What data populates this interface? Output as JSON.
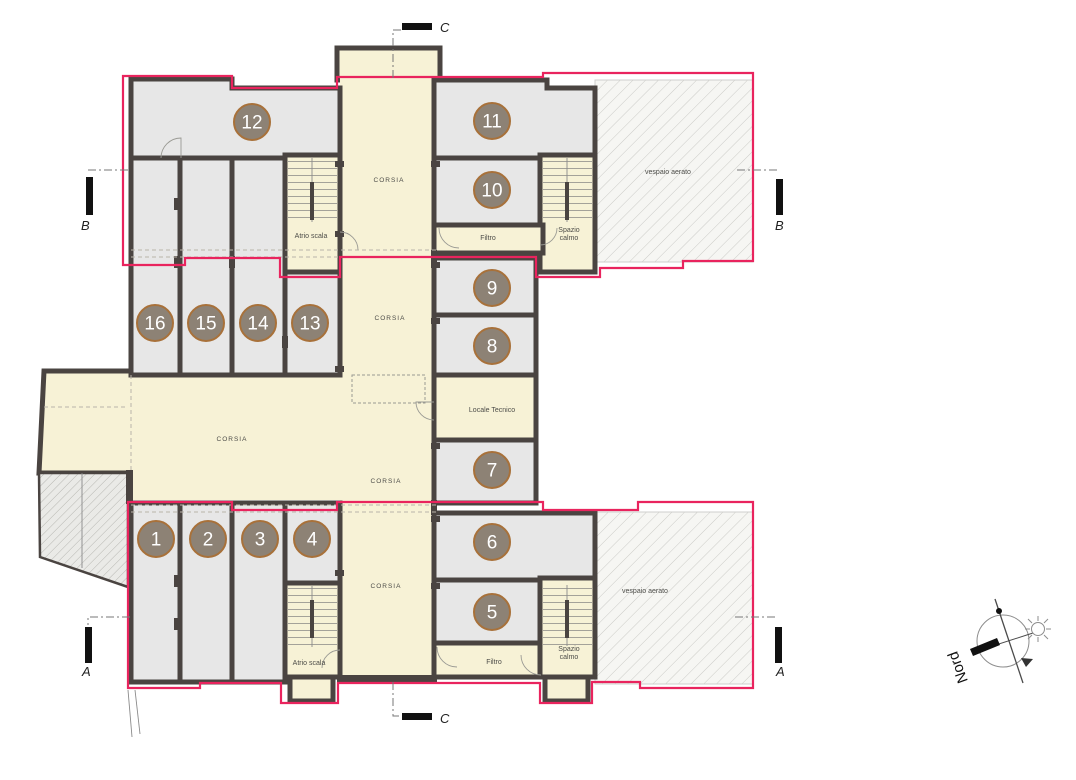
{
  "plan": {
    "colors": {
      "wall": "#4a4441",
      "room_fill": "#e7e7e7",
      "corridor_fill": "#f7f2d6",
      "outline_pink": "#e9245e",
      "circle_fill": "#8d8275",
      "circle_border": "#a8713a",
      "circle_text": "#ffffff"
    },
    "rooms": [
      {
        "number": "1",
        "x": 156,
        "y": 539
      },
      {
        "number": "2",
        "x": 208,
        "y": 539
      },
      {
        "number": "3",
        "x": 260,
        "y": 539
      },
      {
        "number": "4",
        "x": 312,
        "y": 539
      },
      {
        "number": "5",
        "x": 492,
        "y": 612
      },
      {
        "number": "6",
        "x": 492,
        "y": 542
      },
      {
        "number": "7",
        "x": 492,
        "y": 470
      },
      {
        "number": "8",
        "x": 492,
        "y": 346
      },
      {
        "number": "9",
        "x": 492,
        "y": 288
      },
      {
        "number": "10",
        "x": 492,
        "y": 190
      },
      {
        "number": "11",
        "x": 492,
        "y": 121
      },
      {
        "number": "12",
        "x": 252,
        "y": 122
      },
      {
        "number": "13",
        "x": 310,
        "y": 323
      },
      {
        "number": "14",
        "x": 258,
        "y": 323
      },
      {
        "number": "15",
        "x": 206,
        "y": 323
      },
      {
        "number": "16",
        "x": 155,
        "y": 323
      }
    ],
    "labels": [
      {
        "name": "corsia",
        "lines": [
          "CORSIA"
        ],
        "x": 389,
        "y": 182,
        "fs": 6.5,
        "ls": 1
      },
      {
        "name": "corsia",
        "lines": [
          "CORSIA"
        ],
        "x": 390,
        "y": 320,
        "fs": 6.5,
        "ls": 1
      },
      {
        "name": "corsia",
        "lines": [
          "CORSIA"
        ],
        "x": 232,
        "y": 441,
        "fs": 6.5,
        "ls": 1
      },
      {
        "name": "corsia",
        "lines": [
          "CORSIA"
        ],
        "x": 386,
        "y": 483,
        "fs": 6.5,
        "ls": 1
      },
      {
        "name": "corsia",
        "lines": [
          "CORSIA"
        ],
        "x": 386,
        "y": 588,
        "fs": 6.5,
        "ls": 1
      },
      {
        "name": "atrio-scala",
        "lines": [
          "Atrio scala"
        ],
        "x": 311,
        "y": 238,
        "fs": 7,
        "ls": 0
      },
      {
        "name": "atrio-scala",
        "lines": [
          "Atrio scala"
        ],
        "x": 309,
        "y": 665,
        "fs": 7,
        "ls": 0
      },
      {
        "name": "filtro",
        "lines": [
          "Filtro"
        ],
        "x": 488,
        "y": 240,
        "fs": 7,
        "ls": 0
      },
      {
        "name": "filtro",
        "lines": [
          "Filtro"
        ],
        "x": 494,
        "y": 664,
        "fs": 7,
        "ls": 0
      },
      {
        "name": "spazio-calmo",
        "lines": [
          "Spazio",
          "calmo"
        ],
        "x": 569,
        "y": 232,
        "fs": 7,
        "ls": 0
      },
      {
        "name": "spazio-calmo",
        "lines": [
          "Spazio",
          "calmo"
        ],
        "x": 569,
        "y": 651,
        "fs": 7,
        "ls": 0
      },
      {
        "name": "locale-tecnico",
        "lines": [
          "Locale Tecnico"
        ],
        "x": 492,
        "y": 412,
        "fs": 7,
        "ls": 0
      },
      {
        "name": "vespaio-aerato",
        "lines": [
          "vespaio aerato"
        ],
        "x": 668,
        "y": 174,
        "fs": 7,
        "ls": 0
      },
      {
        "name": "vespaio-aerato",
        "lines": [
          "vespaio aerato"
        ],
        "x": 645,
        "y": 593,
        "fs": 7,
        "ls": 0
      }
    ],
    "sections": {
      "a": "A",
      "b": "B",
      "c": "C"
    },
    "compass": {
      "label": "Nord"
    }
  }
}
